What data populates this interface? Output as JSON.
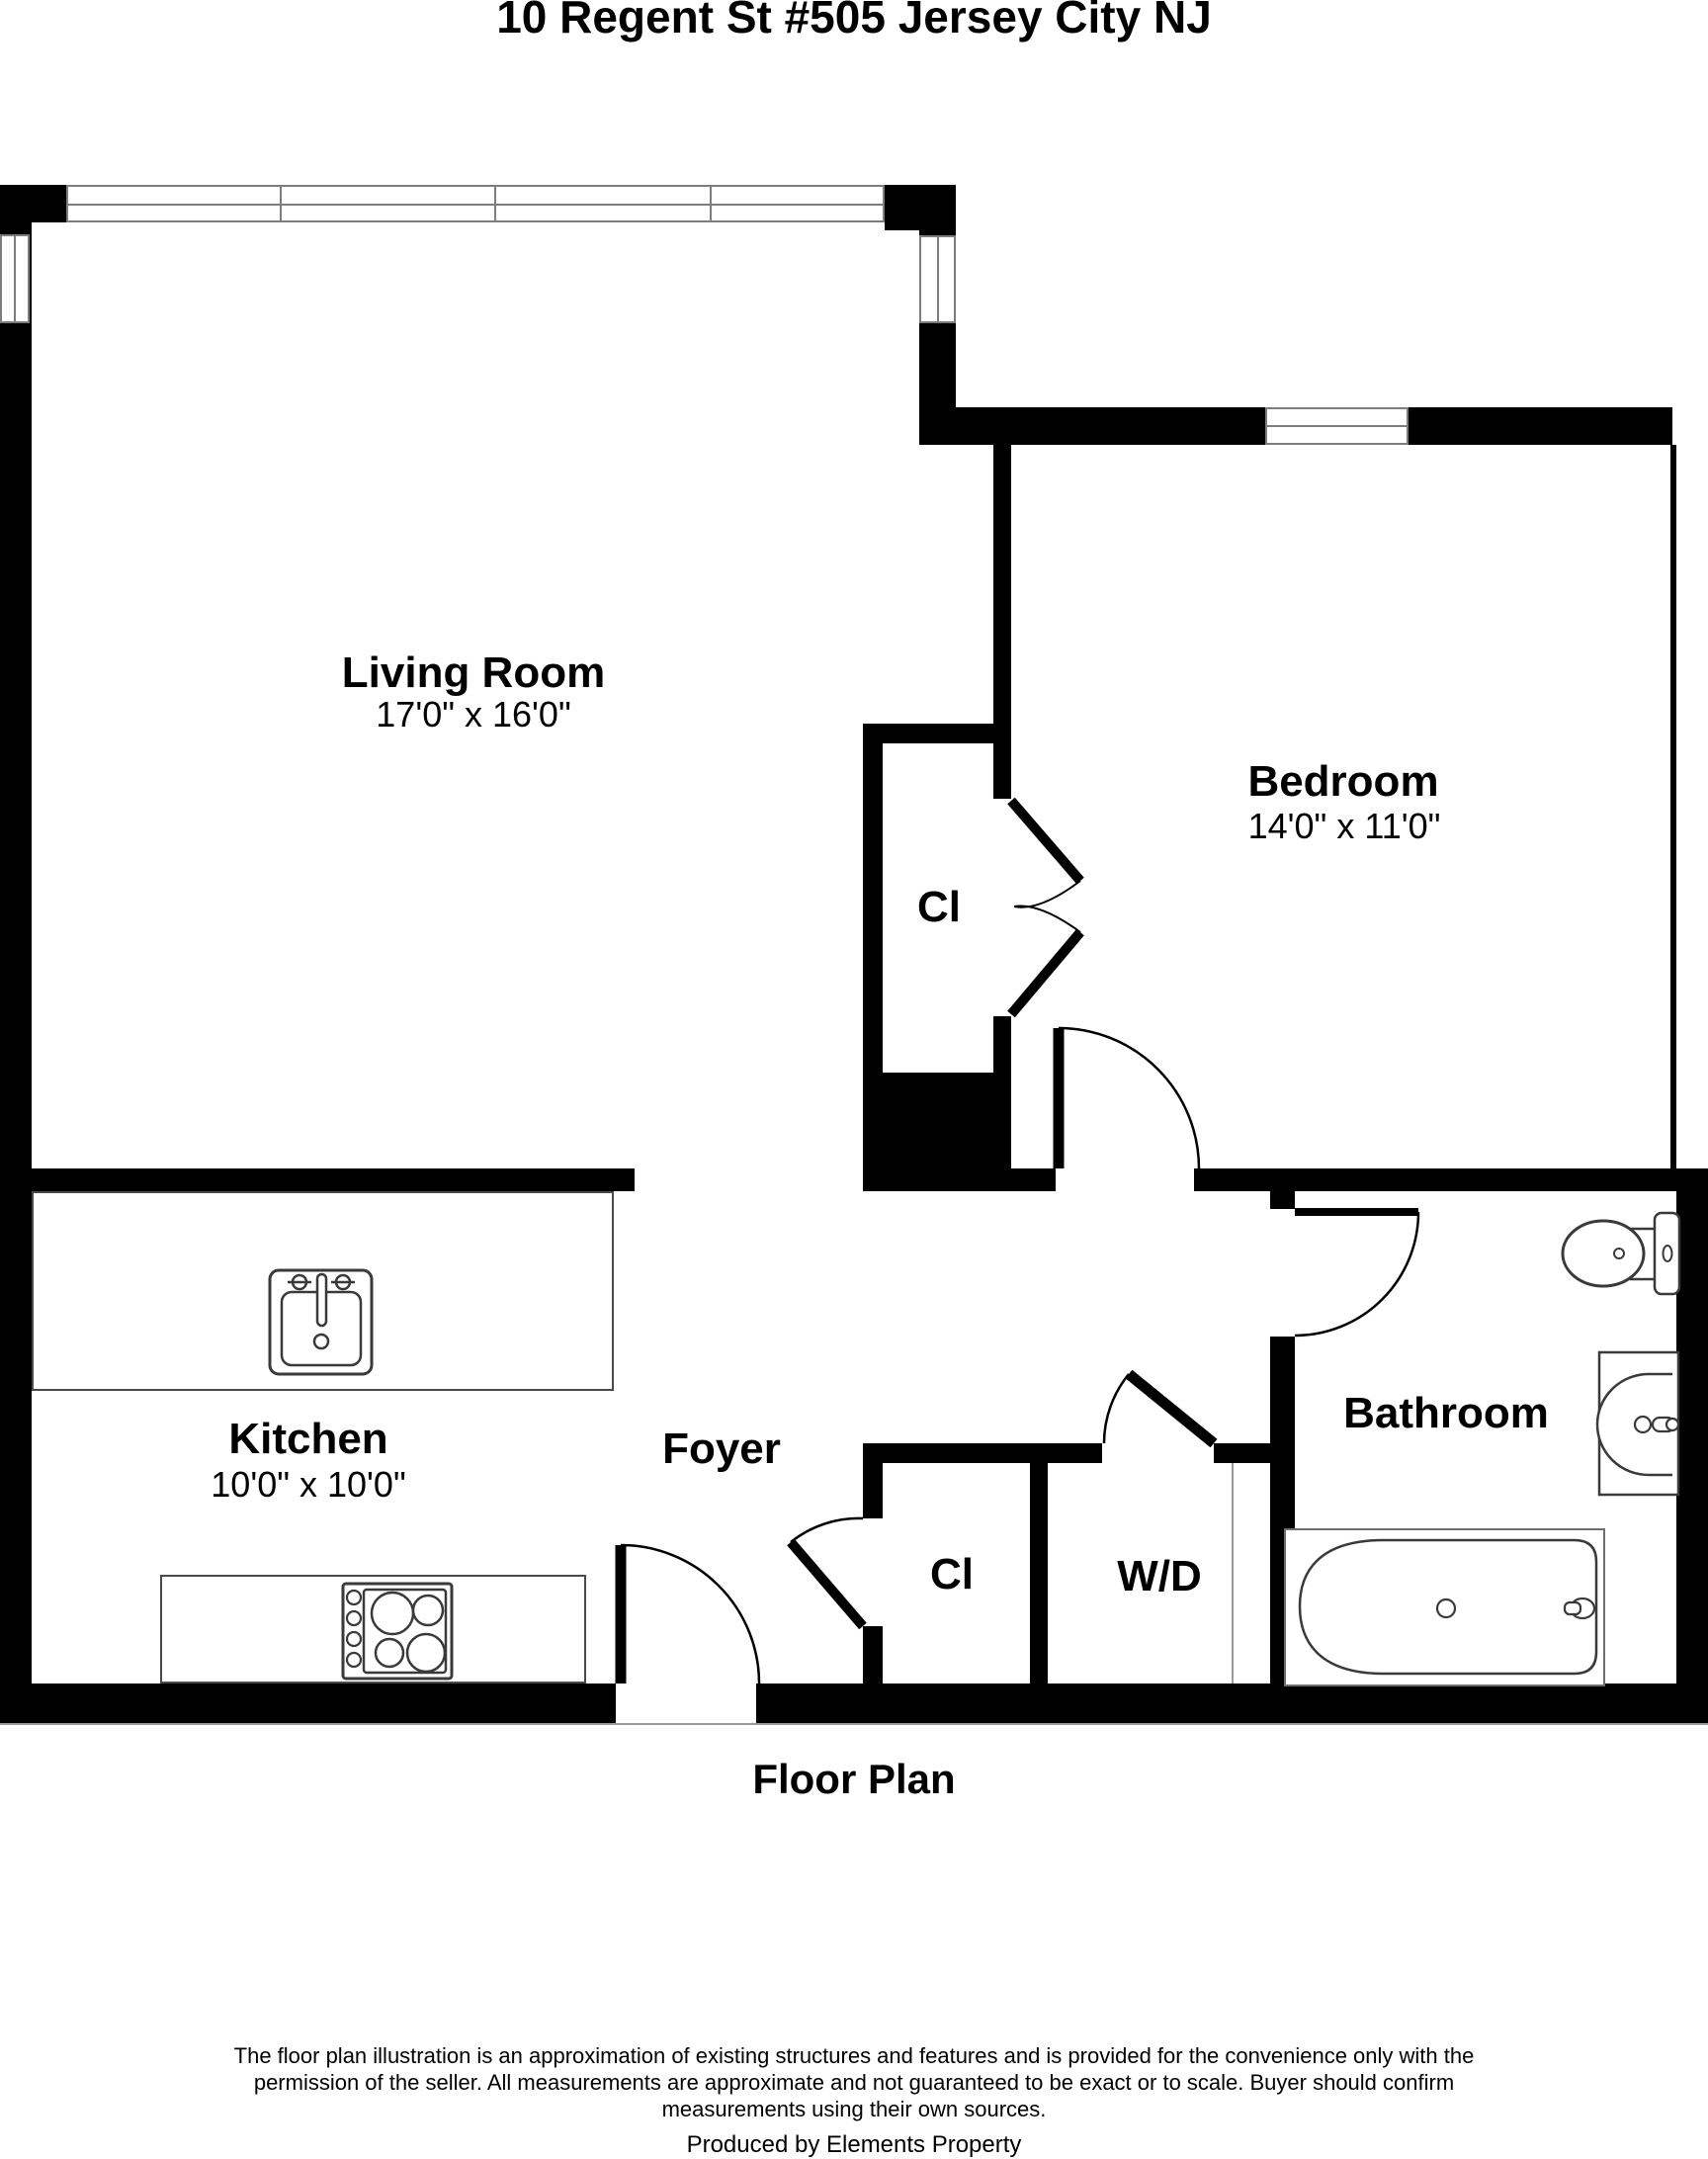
{
  "title": "10 Regent St #505 Jersey City NJ",
  "caption": "Floor Plan",
  "rooms": {
    "living_room": {
      "name": "Living Room",
      "dims": "17'0\" x 16'0\""
    },
    "bedroom": {
      "name": "Bedroom",
      "dims": "14'0\" x 11'0\""
    },
    "kitchen": {
      "name": "Kitchen",
      "dims": "10'0\" x 10'0\""
    },
    "foyer": {
      "name": "Foyer"
    },
    "bathroom": {
      "name": "Bathroom"
    },
    "bedroom_closet": {
      "name": "Cl"
    },
    "foyer_closet": {
      "name": "Cl"
    },
    "washer_dryer": {
      "name": "W/D"
    }
  },
  "footer": {
    "disclaimer_line1": "The floor plan illustration is an approximation of existing structures and features and is provided for the convenience only with the",
    "disclaimer_line2": "permission of the seller. All measurements are approximate and not guaranteed to be exact or to scale. Buyer should confirm",
    "disclaimer_line3": "measurements using their own sources.",
    "produced_by": "Produced by Elements Property"
  },
  "colors": {
    "wall": "#000000",
    "window_line": "#7d7d7d",
    "fixture_line": "#3a3a3a"
  }
}
